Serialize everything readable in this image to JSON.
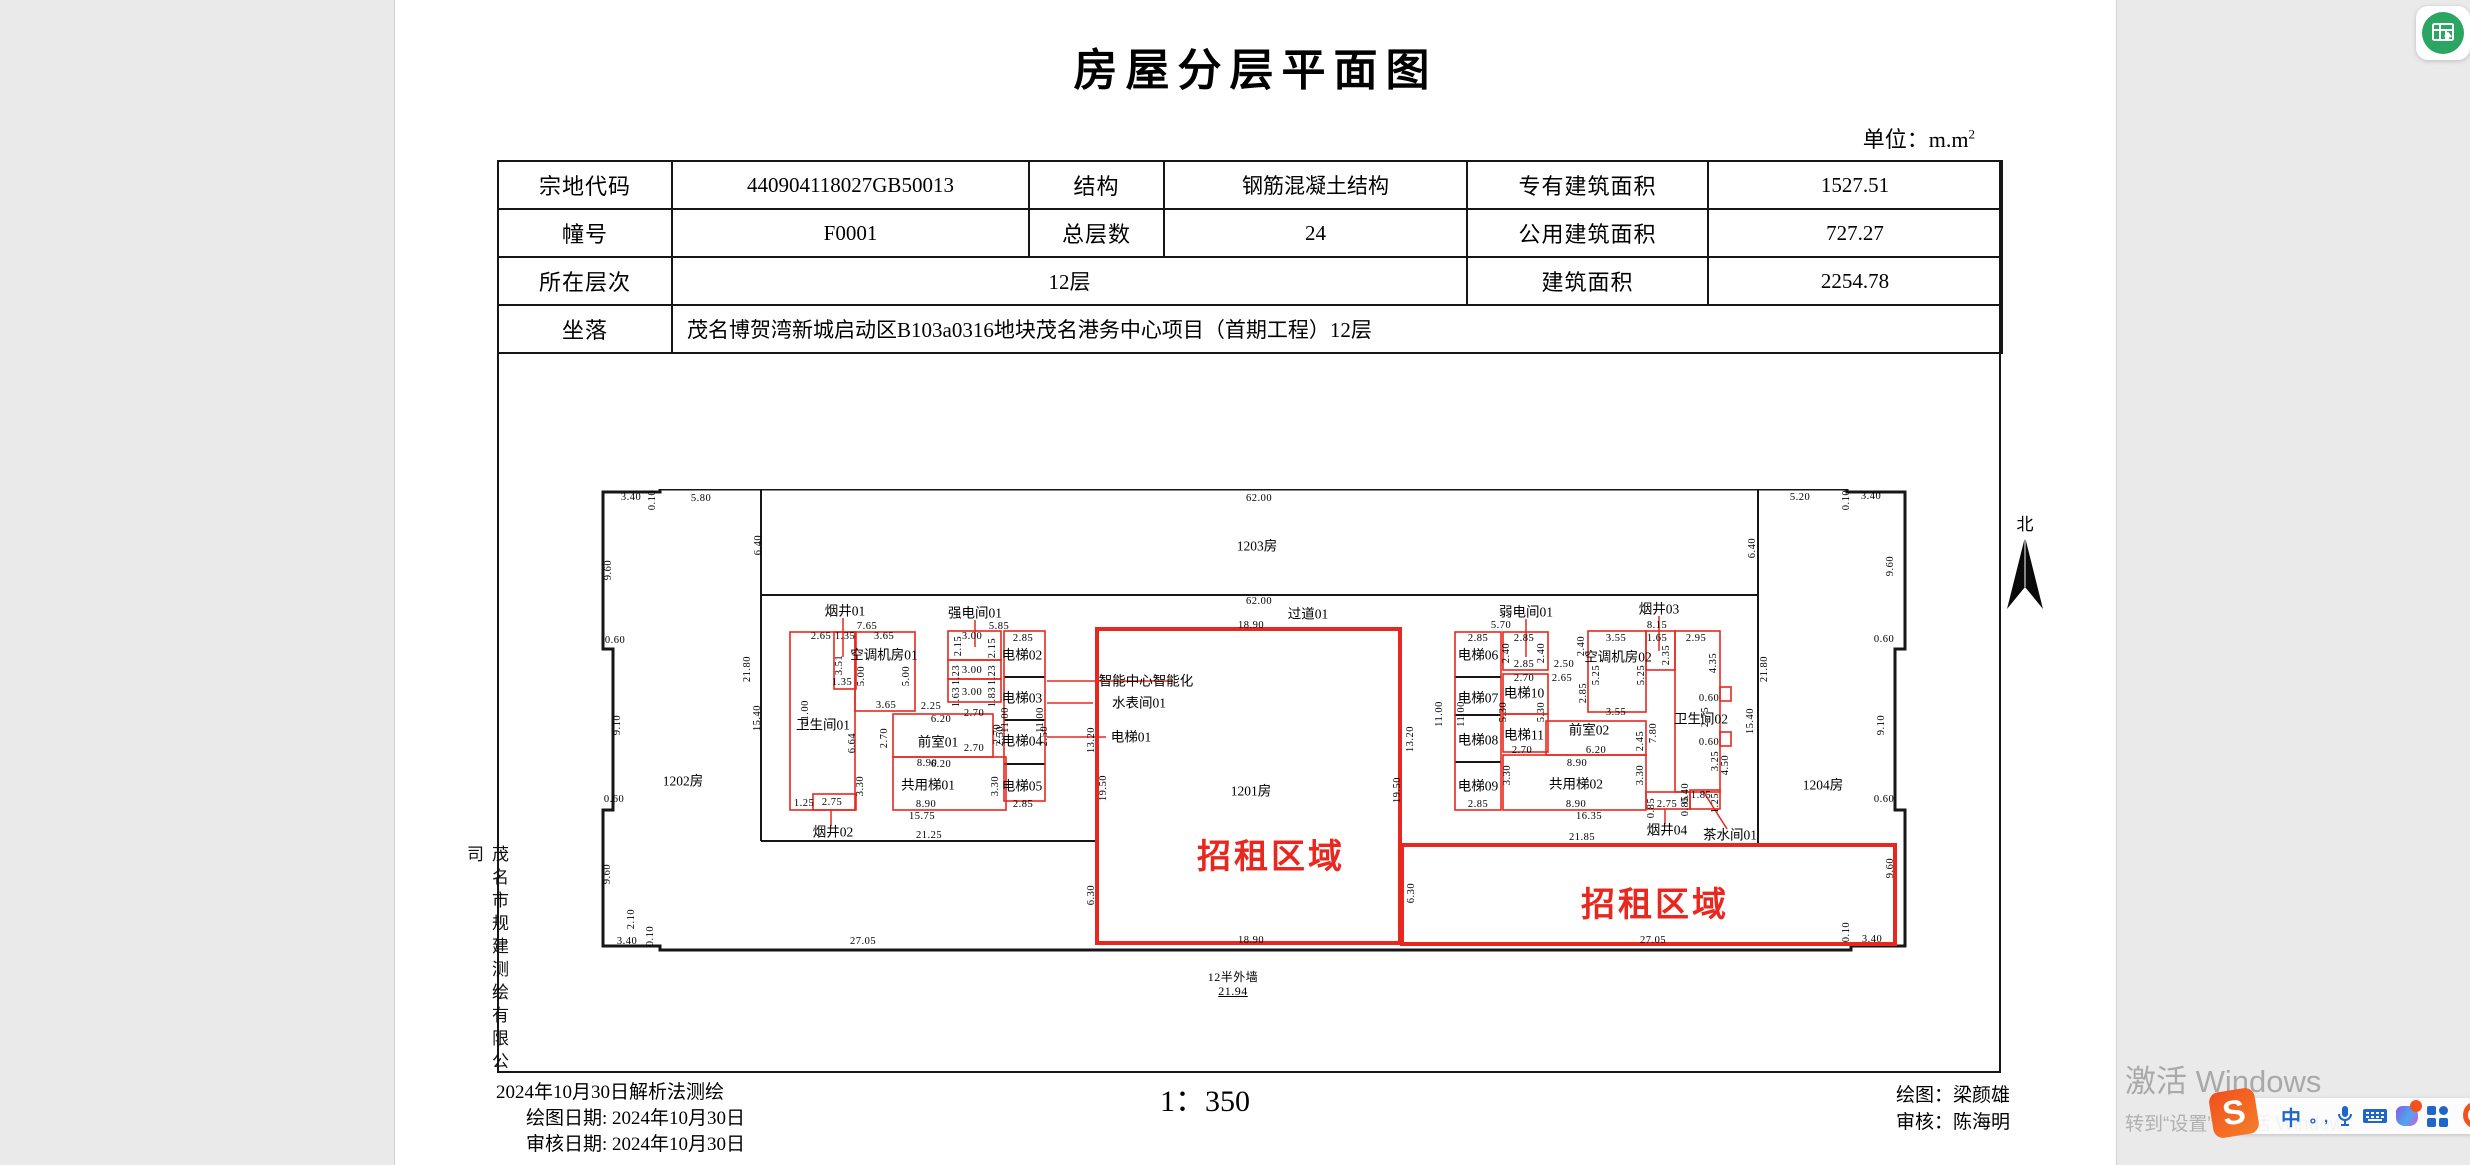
{
  "page": {
    "title": "房屋分层平面图",
    "unit_label": "单位：m.m",
    "unit_sup": "2",
    "scale": "1：350",
    "company_vertical": "茂名市规建测绘有限公司",
    "footer_dates": [
      "2024年10月30日解析法测绘",
      "绘图日期: 2024年10月30日",
      "审核日期: 2024年10月30日"
    ],
    "footer_names": [
      "绘图：梁颜雄",
      "审核：陈海明"
    ]
  },
  "info_table": {
    "col_widths": [
      174,
      357,
      135,
      303,
      241,
      294
    ],
    "rows": [
      [
        {
          "t": "宗地代码",
          "h": true
        },
        {
          "t": "440904118027GB50013"
        },
        {
          "t": "结构",
          "h": true
        },
        {
          "t": "钢筋混凝土结构"
        },
        {
          "t": "专有建筑面积",
          "h": true
        },
        {
          "t": "1527.51"
        }
      ],
      [
        {
          "t": "幢号",
          "h": true
        },
        {
          "t": "F0001"
        },
        {
          "t": "总层数",
          "h": true
        },
        {
          "t": "24"
        },
        {
          "t": "公用建筑面积",
          "h": true
        },
        {
          "t": "727.27"
        }
      ],
      [
        {
          "t": "所在层次",
          "h": true
        },
        {
          "t": "12层",
          "cs": 3
        },
        {
          "t": "建筑面积",
          "h": true
        },
        {
          "t": "2254.78"
        }
      ],
      [
        {
          "t": "坐落",
          "h": true
        },
        {
          "t": "茂名博贺湾新城启动区B103a0316地块茂名港务中心项目（首期工程）12层",
          "cs": 5,
          "left": true
        }
      ]
    ]
  },
  "plan": {
    "north_label": "北",
    "accent_red": "#e8281e",
    "room_labels": [
      {
        "t": "1202房",
        "x": 82,
        "y": 292
      },
      {
        "t": "1203房",
        "x": 656,
        "y": 57
      },
      {
        "t": "1204房",
        "x": 1222,
        "y": 296
      },
      {
        "t": "1201房",
        "x": 650,
        "y": 302
      },
      {
        "t": "过道01",
        "x": 707,
        "y": 125
      },
      {
        "t": "烟井01",
        "x": 244,
        "y": 122
      },
      {
        "t": "强电间01",
        "x": 374,
        "y": 124
      },
      {
        "t": "空调机房01",
        "x": 283,
        "y": 166
      },
      {
        "t": "卫生间01",
        "x": 222,
        "y": 236
      },
      {
        "t": "前室01",
        "x": 337,
        "y": 253
      },
      {
        "t": "共用梯01",
        "x": 327,
        "y": 296
      },
      {
        "t": "烟井02",
        "x": 232,
        "y": 343
      },
      {
        "t": "电梯01",
        "x": 530,
        "y": 248
      },
      {
        "t": "电梯02",
        "x": 421,
        "y": 166
      },
      {
        "t": "电梯03",
        "x": 421,
        "y": 209
      },
      {
        "t": "电梯04",
        "x": 421,
        "y": 252
      },
      {
        "t": "电梯05",
        "x": 421,
        "y": 297
      },
      {
        "t": "智能中心智能化",
        "x": 545,
        "y": 192
      },
      {
        "t": "水表间01",
        "x": 538,
        "y": 214
      },
      {
        "t": "弱电间01",
        "x": 925,
        "y": 123
      },
      {
        "t": "烟井03",
        "x": 1058,
        "y": 120
      },
      {
        "t": "空调机房02",
        "x": 1017,
        "y": 168
      },
      {
        "t": "电梯06",
        "x": 877,
        "y": 166
      },
      {
        "t": "电梯07",
        "x": 877,
        "y": 209
      },
      {
        "t": "电梯08",
        "x": 877,
        "y": 251
      },
      {
        "t": "电梯09",
        "x": 877,
        "y": 297
      },
      {
        "t": "电梯10",
        "x": 923,
        "y": 204
      },
      {
        "t": "电梯11",
        "x": 923,
        "y": 246
      },
      {
        "t": "前室02",
        "x": 988,
        "y": 241
      },
      {
        "t": "共用梯02",
        "x": 975,
        "y": 295
      },
      {
        "t": "卫生间02",
        "x": 1100,
        "y": 230
      },
      {
        "t": "烟井04",
        "x": 1066,
        "y": 341
      },
      {
        "t": "茶水间01",
        "x": 1129,
        "y": 346
      }
    ],
    "rental_labels": [
      {
        "t": "招租区域",
        "x": 670,
        "y": 368
      },
      {
        "t": "招租区域",
        "x": 1054,
        "y": 416
      }
    ],
    "dim_labels": [
      {
        "t": "3.40",
        "x": 30,
        "y": 9
      },
      {
        "t": "0.10",
        "x": 52,
        "y": 11,
        "r": 1
      },
      {
        "t": "5.80",
        "x": 100,
        "y": 10
      },
      {
        "t": "9.60",
        "x": 8,
        "y": 81,
        "r": 1
      },
      {
        "t": "0.60",
        "x": 14,
        "y": 152
      },
      {
        "t": "9.10",
        "x": 17,
        "y": 236,
        "r": 1
      },
      {
        "t": "0.60",
        "x": 13,
        "y": 311
      },
      {
        "t": "9.60",
        "x": 7,
        "y": 385,
        "r": 1
      },
      {
        "t": "2.10",
        "x": 31,
        "y": 430,
        "r": 1
      },
      {
        "t": "3.40",
        "x": 26,
        "y": 453
      },
      {
        "t": "0.10",
        "x": 50,
        "y": 447,
        "r": 1
      },
      {
        "t": "27.05",
        "x": 262,
        "y": 453
      },
      {
        "t": "6.40",
        "x": 158,
        "y": 56,
        "r": 1
      },
      {
        "t": "21.80",
        "x": 147,
        "y": 180,
        "r": 1
      },
      {
        "t": "15.40",
        "x": 157,
        "y": 229,
        "r": 1
      },
      {
        "t": "62.00",
        "x": 658,
        "y": 10
      },
      {
        "t": "62.00",
        "x": 658,
        "y": 113
      },
      {
        "t": "18.90",
        "x": 650,
        "y": 137
      },
      {
        "t": "18.90",
        "x": 650,
        "y": 452
      },
      {
        "t": "5.20",
        "x": 1199,
        "y": 9
      },
      {
        "t": "0.10",
        "x": 1246,
        "y": 11,
        "r": 1
      },
      {
        "t": "3.40",
        "x": 1270,
        "y": 8
      },
      {
        "t": "9.60",
        "x": 1290,
        "y": 77,
        "r": 1
      },
      {
        "t": "0.60",
        "x": 1283,
        "y": 151
      },
      {
        "t": "9.10",
        "x": 1281,
        "y": 236,
        "r": 1
      },
      {
        "t": "0.60",
        "x": 1283,
        "y": 311
      },
      {
        "t": "9.60",
        "x": 1290,
        "y": 379,
        "r": 1
      },
      {
        "t": "0.10",
        "x": 1246,
        "y": 443,
        "r": 1
      },
      {
        "t": "3.40",
        "x": 1271,
        "y": 451
      },
      {
        "t": "6.40",
        "x": 1152,
        "y": 59,
        "r": 1
      },
      {
        "t": "21.80",
        "x": 1164,
        "y": 180,
        "r": 1
      },
      {
        "t": "15.40",
        "x": 1150,
        "y": 232,
        "r": 1
      },
      {
        "t": "13.20",
        "x": 491,
        "y": 251,
        "r": 1
      },
      {
        "t": "13.20",
        "x": 810,
        "y": 250,
        "r": 1
      },
      {
        "t": "19.50",
        "x": 503,
        "y": 299,
        "r": 1
      },
      {
        "t": "19.50",
        "x": 797,
        "y": 301,
        "r": 1
      },
      {
        "t": "6.30",
        "x": 491,
        "y": 406,
        "r": 1
      },
      {
        "t": "6.30",
        "x": 811,
        "y": 404,
        "r": 1
      },
      {
        "t": "27.05",
        "x": 1052,
        "y": 452
      },
      {
        "t": "7.65",
        "x": 266,
        "y": 138
      },
      {
        "t": "2.65",
        "x": 220,
        "y": 148
      },
      {
        "t": "1.35",
        "x": 244,
        "y": 148
      },
      {
        "t": "3.65",
        "x": 283,
        "y": 148
      },
      {
        "t": "3.51",
        "x": 239,
        "y": 176,
        "r": 1
      },
      {
        "t": "5.00",
        "x": 261,
        "y": 187,
        "r": 1
      },
      {
        "t": "5.00",
        "x": 306,
        "y": 187,
        "r": 1
      },
      {
        "t": "1.35",
        "x": 241,
        "y": 194
      },
      {
        "t": "3.65",
        "x": 285,
        "y": 217
      },
      {
        "t": "2.25",
        "x": 330,
        "y": 218
      },
      {
        "t": "5.85",
        "x": 398,
        "y": 138
      },
      {
        "t": "3.00",
        "x": 371,
        "y": 148
      },
      {
        "t": "2.15",
        "x": 358,
        "y": 157,
        "r": 1
      },
      {
        "t": "2.15",
        "x": 392,
        "y": 159,
        "r": 1
      },
      {
        "t": "2.85",
        "x": 422,
        "y": 150
      },
      {
        "t": "1.23",
        "x": 356,
        "y": 186,
        "r": 1
      },
      {
        "t": "3.00",
        "x": 371,
        "y": 182
      },
      {
        "t": "1.23",
        "x": 392,
        "y": 186,
        "r": 1
      },
      {
        "t": "1.63",
        "x": 356,
        "y": 208,
        "r": 1
      },
      {
        "t": "3.00",
        "x": 371,
        "y": 204
      },
      {
        "t": "1.83",
        "x": 392,
        "y": 208,
        "r": 1
      },
      {
        "t": "2.70",
        "x": 373,
        "y": 225
      },
      {
        "t": "11.00",
        "x": 205,
        "y": 224,
        "r": 1
      },
      {
        "t": "11.00",
        "x": 405,
        "y": 231,
        "r": 1
      },
      {
        "t": "11.00",
        "x": 440,
        "y": 231,
        "r": 1
      },
      {
        "t": "2.50",
        "x": 400,
        "y": 247,
        "r": 1
      },
      {
        "t": "2.50",
        "x": 444,
        "y": 247,
        "r": 1
      },
      {
        "t": "2.70",
        "x": 373,
        "y": 260
      },
      {
        "t": "6.20",
        "x": 340,
        "y": 231
      },
      {
        "t": "6.20",
        "x": 340,
        "y": 276
      },
      {
        "t": "2.70",
        "x": 284,
        "y": 249,
        "r": 1
      },
      {
        "t": "2.70",
        "x": 397,
        "y": 245,
        "r": 1
      },
      {
        "t": "6.64",
        "x": 252,
        "y": 254,
        "r": 1
      },
      {
        "t": "8.90",
        "x": 326,
        "y": 275
      },
      {
        "t": "8.90",
        "x": 325,
        "y": 316
      },
      {
        "t": "3.30",
        "x": 260,
        "y": 297,
        "r": 1
      },
      {
        "t": "3.30",
        "x": 395,
        "y": 297,
        "r": 1
      },
      {
        "t": "2.85",
        "x": 422,
        "y": 316
      },
      {
        "t": "1.25",
        "x": 203,
        "y": 315
      },
      {
        "t": "2.75",
        "x": 231,
        "y": 314
      },
      {
        "t": "15.75",
        "x": 321,
        "y": 328
      },
      {
        "t": "21.25",
        "x": 328,
        "y": 347
      },
      {
        "t": "5.70",
        "x": 900,
        "y": 137
      },
      {
        "t": "2.85",
        "x": 877,
        "y": 150
      },
      {
        "t": "2.85",
        "x": 923,
        "y": 150
      },
      {
        "t": "2.40",
        "x": 906,
        "y": 164,
        "r": 1
      },
      {
        "t": "2.40",
        "x": 941,
        "y": 164,
        "r": 1
      },
      {
        "t": "2.85",
        "x": 923,
        "y": 176
      },
      {
        "t": "2.70",
        "x": 923,
        "y": 190
      },
      {
        "t": "2.50",
        "x": 963,
        "y": 176
      },
      {
        "t": "2.65",
        "x": 961,
        "y": 190
      },
      {
        "t": "2.40",
        "x": 981,
        "y": 157,
        "r": 1
      },
      {
        "t": "5.25",
        "x": 996,
        "y": 186,
        "r": 1
      },
      {
        "t": "3.55",
        "x": 1015,
        "y": 150
      },
      {
        "t": "8.15",
        "x": 1056,
        "y": 137
      },
      {
        "t": "1.65",
        "x": 1056,
        "y": 150
      },
      {
        "t": "2.95",
        "x": 1095,
        "y": 150
      },
      {
        "t": "2.35",
        "x": 1066,
        "y": 166,
        "r": 1
      },
      {
        "t": "4.35",
        "x": 1113,
        "y": 174,
        "r": 1
      },
      {
        "t": "5.25",
        "x": 1041,
        "y": 186,
        "r": 1
      },
      {
        "t": "2.85",
        "x": 983,
        "y": 204,
        "r": 1
      },
      {
        "t": "3.55",
        "x": 1015,
        "y": 224
      },
      {
        "t": "0.60",
        "x": 1108,
        "y": 210
      },
      {
        "t": "2.75",
        "x": 1105,
        "y": 228,
        "r": 1
      },
      {
        "t": "0.60",
        "x": 1108,
        "y": 254
      },
      {
        "t": "3.25",
        "x": 1115,
        "y": 272,
        "r": 1
      },
      {
        "t": "4.50",
        "x": 1125,
        "y": 276,
        "r": 1
      },
      {
        "t": "2.45",
        "x": 1040,
        "y": 252,
        "r": 1
      },
      {
        "t": "7.80",
        "x": 1053,
        "y": 244,
        "r": 1
      },
      {
        "t": "6.20",
        "x": 995,
        "y": 262
      },
      {
        "t": "2.70",
        "x": 921,
        "y": 262
      },
      {
        "t": "5.30",
        "x": 903,
        "y": 223,
        "r": 1
      },
      {
        "t": "5.30",
        "x": 941,
        "y": 223,
        "r": 1
      },
      {
        "t": "11.00",
        "x": 839,
        "y": 225,
        "r": 1
      },
      {
        "t": "11.00",
        "x": 861,
        "y": 225,
        "r": 1
      },
      {
        "t": "8.90",
        "x": 976,
        "y": 275
      },
      {
        "t": "3.30",
        "x": 907,
        "y": 286,
        "r": 1
      },
      {
        "t": "3.30",
        "x": 1040,
        "y": 286,
        "r": 1
      },
      {
        "t": "8.90",
        "x": 975,
        "y": 316
      },
      {
        "t": "2.85",
        "x": 877,
        "y": 316
      },
      {
        "t": "0.85",
        "x": 1051,
        "y": 319,
        "r": 1
      },
      {
        "t": "2.75",
        "x": 1066,
        "y": 316
      },
      {
        "t": "0.40",
        "x": 1085,
        "y": 304,
        "r": 1
      },
      {
        "t": "0.85",
        "x": 1085,
        "y": 317,
        "r": 1
      },
      {
        "t": "1.85",
        "x": 1100,
        "y": 307
      },
      {
        "t": "1.25",
        "x": 1115,
        "y": 314,
        "r": 1
      },
      {
        "t": "16.35",
        "x": 988,
        "y": 328
      },
      {
        "t": "21.85",
        "x": 981,
        "y": 349
      },
      {
        "t": "12半外墙",
        "x": 632,
        "y": 488,
        "s": 12
      },
      {
        "t": "21.94",
        "x": 632,
        "y": 502,
        "s": 12,
        "u": 1
      }
    ]
  },
  "watermark": {
    "line1": "激活 Windows",
    "line2": "转到“设置”以激活 Windows"
  },
  "ime": {
    "logo": "S",
    "zh_mode": "中",
    "punct": "。,"
  }
}
